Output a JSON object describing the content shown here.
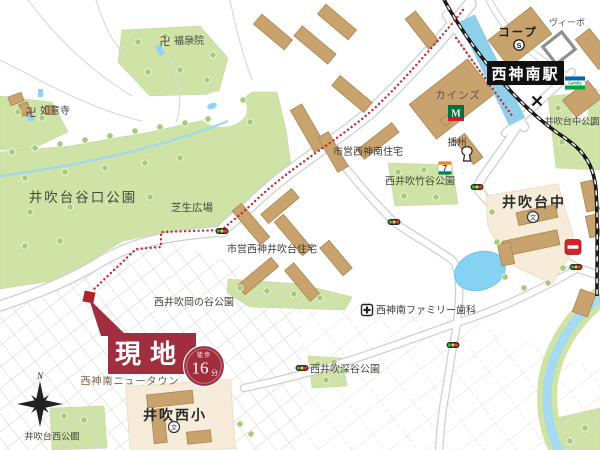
{
  "site": {
    "label": "現地",
    "walk_prefix": "徒歩",
    "walk_minutes": "16",
    "walk_unit": "分"
  },
  "station": {
    "label": "西神南駅"
  },
  "places": {
    "coop": "コープ",
    "coop_s": "S",
    "vivo": "ヴィーボ",
    "cainz": "カインズ",
    "m_logo": "M",
    "banshu": "播州",
    "familymart": "Family",
    "seven": "7",
    "ibukidai_naka_park": "井吹台中公園",
    "ibukidai_naka_js": "井吹台中",
    "school_mark": "文",
    "temple_mark": "卍",
    "shiei_seishin_minami_jutaku": "市営西神南住宅",
    "nishi_ibuki_takedani_park": "西井吹竹谷公園",
    "ibukidai_taniguchi_park": "井吹台谷口公園",
    "shibafu_hiroba": "芝生広場",
    "shiei_seishin_ibukidai_jutaku": "市営西神井吹台住宅",
    "nishi_ibuki_okanotani_park": "西井吹岡の谷公園",
    "family_dental": "西神南ファミリー歯科",
    "nishi_ibuki_fukatani_park": "西井吹深谷公園",
    "seishin_minami_newtown": "西神南ニュータウン",
    "ibuki_nishi_es": "井吹西小",
    "ibukidai_nishi_park": "井吹台西公園",
    "nyoiji_temple": "如意寺",
    "fukusenin_temple": "福泉院",
    "compass_n": "N"
  },
  "colors": {
    "site_red": "#a12e3e",
    "route_red": "#c9252f",
    "park_green": "#cfe3a6",
    "tree_green": "#a8cb7c",
    "building_tan": "#c9a36e",
    "water_blue": "#8fd4f2",
    "campus_cream": "#f6ecd9",
    "railway_black": "#1a1a1a",
    "road_casing": "#cfcfcf"
  }
}
